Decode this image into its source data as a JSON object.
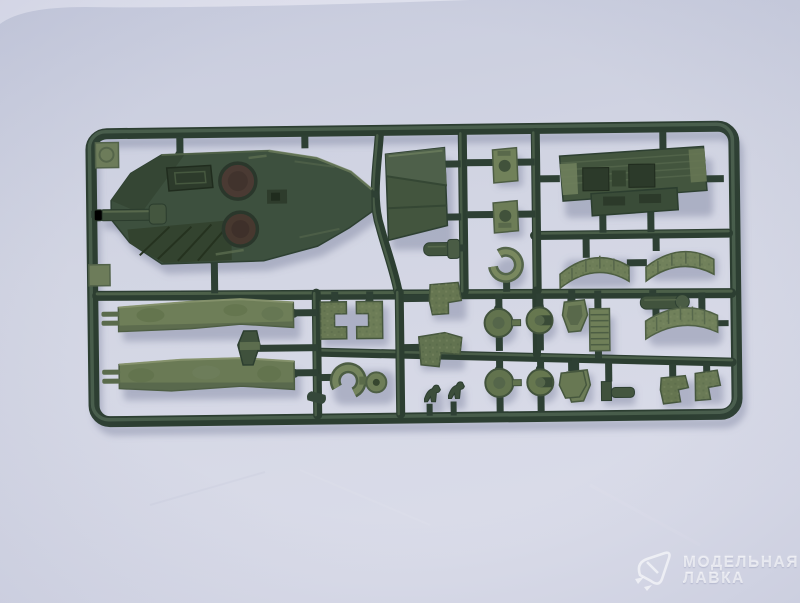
{
  "photo": {
    "subject": "dark olive-green injection-molded plastic model sprue (tank kit parts tree) photographed on a light lavender-gray surface",
    "parts": [
      "upper-hull",
      "gun-barrel",
      "rear-hull-plate",
      "small-detail-plate-1",
      "small-detail-plate-2",
      "engine-deck",
      "curved-fender-1",
      "curved-fender-2",
      "open-ring-clamp",
      "side-skirt-1",
      "side-skirt-2",
      "periscope-block",
      "step-bracket-1",
      "step-bracket-2",
      "tow-clamp-with-disc",
      "riveted-bracket-1",
      "riveted-bracket-2",
      "round-hatch-1",
      "round-hatch-2",
      "round-hatch-3",
      "round-hatch-4",
      "seat-bucket-1",
      "seat-bucket-2",
      "ribbed-grille",
      "curved-mudguard",
      "small-cylinder",
      "tiny-figure-1",
      "tiny-figure-2",
      "bottom-right-bracket-1",
      "bottom-right-bracket-2",
      "bottom-right-fitting"
    ]
  },
  "watermark": {
    "line1": "МОДЕЛЬНАЯ",
    "line2": "ЛАВКА",
    "logo": "origami-arrow-logo"
  },
  "palette": {
    "background_top": "#c9cdde",
    "background_bottom": "#d9dbe8",
    "plastic_dark": "#2c3e31",
    "plastic_mid": "#42553f",
    "plastic_light_olive": "#72825b",
    "hatch_opening_brown": "#4a3a33",
    "shadow": "rgba(104,112,144,0.38)",
    "watermark_text": "rgba(255,255,255,0.62)"
  }
}
